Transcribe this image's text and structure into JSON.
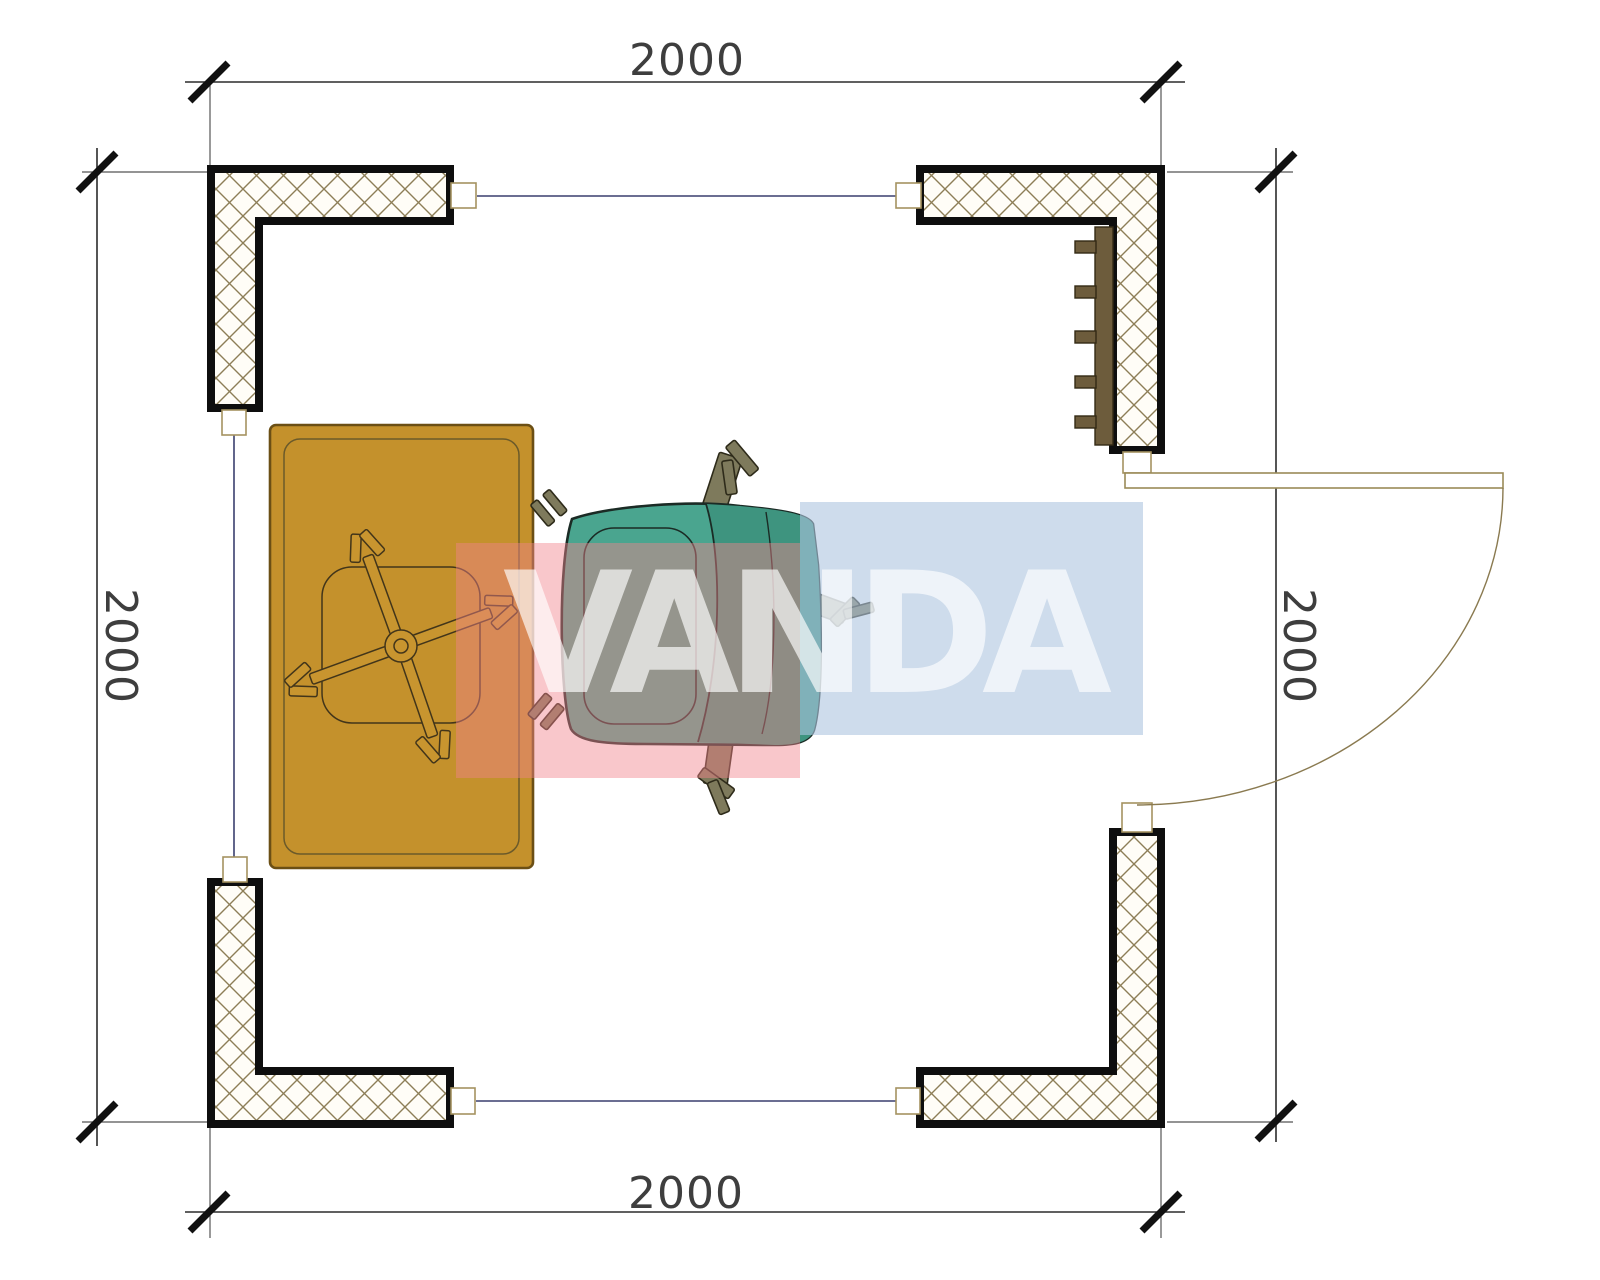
{
  "plan": {
    "dimensions": {
      "top": "2000",
      "bottom": "2000",
      "left": "2000",
      "right": "2000"
    },
    "watermark": {
      "text": "VANDA",
      "red_block_color": "#F2838C",
      "blue_block_color": "#AEC4E0",
      "letter_color": "#FFFFFF"
    },
    "colors": {
      "hatch_line": "#8D7E57",
      "wall_outline": "#0E0E0E",
      "window_line": "#3A3F6E",
      "marker_border": "#A59260",
      "dim_line": "#2B2B2B",
      "extension_line": "#555555",
      "door_line": "#8A7A50",
      "table_fill": "#C4912C",
      "table_border": "#6B4F15",
      "stool_line": "#42351A",
      "stool_arm_fill": "#C8952F",
      "chair_fill": "#4AA58F",
      "chair_back_fill": "#3E947F",
      "chair_outline": "#1B2B25",
      "leg_fill": "#7E7A5C",
      "leg_outline": "#2E2B1A",
      "radiator_fill": "#6D5C3C",
      "radiator_border": "#332A15"
    }
  }
}
